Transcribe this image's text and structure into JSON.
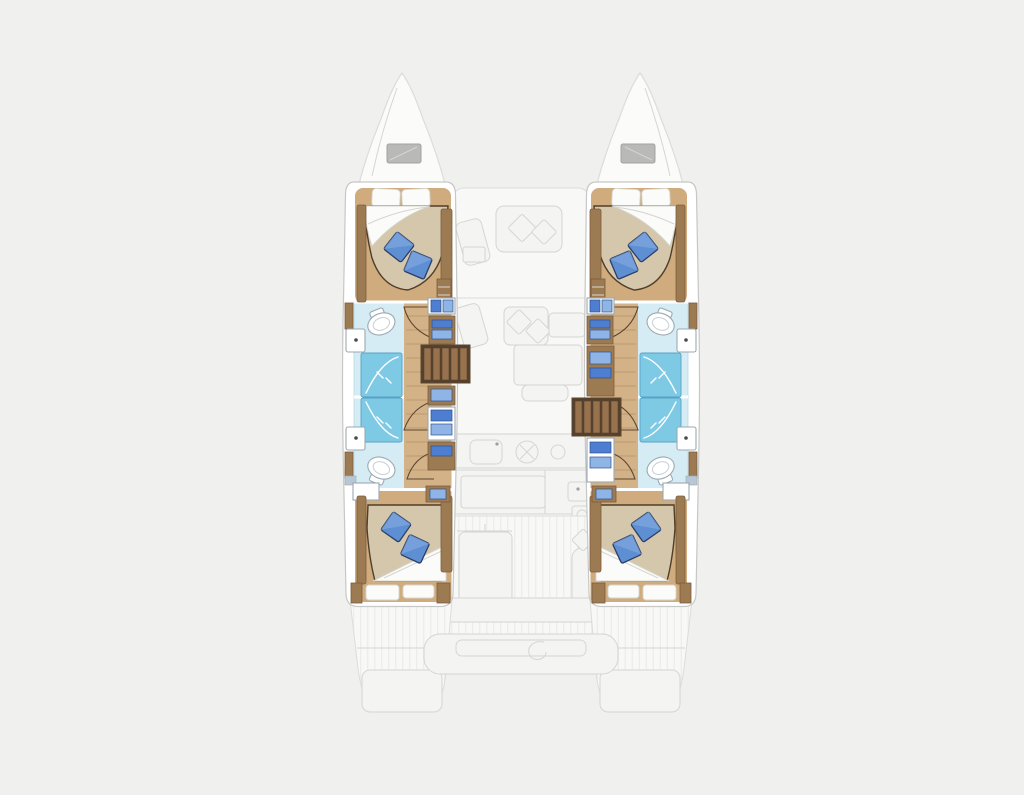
{
  "page": {
    "background": "#f0f0ef",
    "width": 1024,
    "height": 795
  },
  "plan": {
    "type": "catamaran-floorplan-top-view",
    "colors": {
      "background": "#f0f0ef",
      "deck_fill": "#f8f8f6",
      "deck_line": "#dcdcda",
      "deck_stripe": "#ededeb",
      "deck_furniture": "#f4f4f2",
      "deck_furniture_line": "#d5d5d3",
      "bow_fill": "#fbfbfa",
      "hatch_fill": "#b9b9b7",
      "hatch_line": "#a3a3a1",
      "hull_shell": "#ffffff",
      "hull_line": "#c7c7c5",
      "cabin_floor": "#cfab7e",
      "corridor_floor": "#d4b287",
      "plank_line": "rgba(100,70,40,0.22)",
      "wood": "#9d7b52",
      "wood_dark": "#7c5c3c",
      "wood_edge": "#5b4630",
      "steps_base": "#55402b",
      "steps_plank": "#97724d",
      "mattress": "#d4c7ab",
      "mattress_line": "#4e3e2a",
      "linen": "#fbfbf9",
      "linen_line": "#d6d6d0",
      "pillow_blue": "#5f8fd3",
      "pillow_blue_light": "#86aee2",
      "pillow_blue_dark": "#2c3e68",
      "bath_floor": "#d6ecf5",
      "bath_line": "#b5d4e2",
      "shower": "#7ecae5",
      "shower_line": "#58a2c2",
      "porcelain": "#ffffff",
      "porcelain_line": "#9aa9b2",
      "porcelain_inner": "#c3d0d6",
      "fixture_dot": "#4a4a4a",
      "storage_blue": "#4d7ed1",
      "storage_blue_light": "#8fb4e6",
      "storage_blue_dark": "#30518c",
      "window_blue": "#b9c7d4"
    },
    "inventory": {
      "hulls": 2,
      "double_berths": 4,
      "heads": 4,
      "shower_stalls": 4,
      "toilets": 4,
      "washbasins": 4,
      "companionway_steps": 2,
      "bow_hatches": 2,
      "throw_pillows": 8
    },
    "elements": [
      "port-bow",
      "starboard-bow",
      "bow-hatch",
      "forward-cockpit",
      "saloon",
      "saloon-table",
      "galley-sink",
      "galley-stove",
      "aft-cockpit",
      "cockpit-table",
      "davit-console",
      "stern-platform",
      "port-hull",
      "starboard-hull",
      "forward-cabin",
      "aft-cabin",
      "forward-head",
      "aft-head",
      "shower-stall",
      "toilet",
      "washbasin",
      "door-swing",
      "companionway-steps",
      "storage-locker",
      "double-berth",
      "throw-pillow",
      "hull-window"
    ]
  }
}
